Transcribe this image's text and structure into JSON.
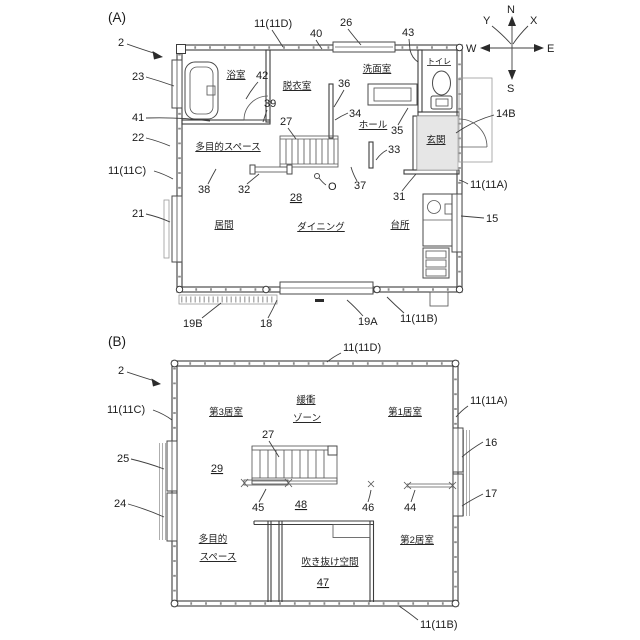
{
  "figure": {
    "a": {
      "label": "(A)",
      "rooms": {
        "bathroom": "浴室",
        "dressing_room": "脱衣室",
        "washroom": "洗面室",
        "toilet": "トイレ",
        "hall": "ホール",
        "entrance": "玄関",
        "multipurpose_space": "多目的スペース",
        "living_room": "居間",
        "dining": "ダイニング",
        "kitchen": "台所"
      },
      "refs": {
        "r2": "2",
        "r11d": "11(11D)",
        "r40": "40",
        "r26": "26",
        "r43": "43",
        "r23": "23",
        "r42": "42",
        "r39": "39",
        "r41": "41",
        "r22": "22",
        "r27": "27",
        "r36": "36",
        "r34": "34",
        "r35": "35",
        "r14b": "14B",
        "r11c": "11(11C)",
        "r33": "33",
        "r38": "38",
        "r32": "32",
        "r28": "28",
        "rO": "O",
        "r37": "37",
        "r31": "31",
        "r11a": "11(11A)",
        "r21": "21",
        "r15": "15",
        "r19b": "19B",
        "r18": "18",
        "r19a": "19A",
        "r11b": "11(11B)"
      }
    },
    "b": {
      "label": "(B)",
      "rooms": {
        "room3": "第3居室",
        "buffer_line1": "緩衝",
        "buffer_line2": "ゾーン",
        "room1": "第1居室",
        "multipurpose_line1": "多目的",
        "multipurpose_line2": "スペース",
        "atrium": "吹き抜け空間",
        "room2": "第2居室"
      },
      "refs": {
        "r2": "2",
        "r11d": "11(11D)",
        "r11c": "11(11C)",
        "r11a": "11(11A)",
        "r11b": "11(11B)",
        "r16": "16",
        "r17": "17",
        "r25": "25",
        "r24": "24",
        "r27": "27",
        "r29": "29",
        "r45": "45",
        "r48": "48",
        "r46": "46",
        "r44": "44",
        "r47": "47"
      }
    },
    "compass": {
      "n": "N",
      "s": "S",
      "e": "E",
      "w": "W",
      "x": "X",
      "y": "Y"
    }
  }
}
